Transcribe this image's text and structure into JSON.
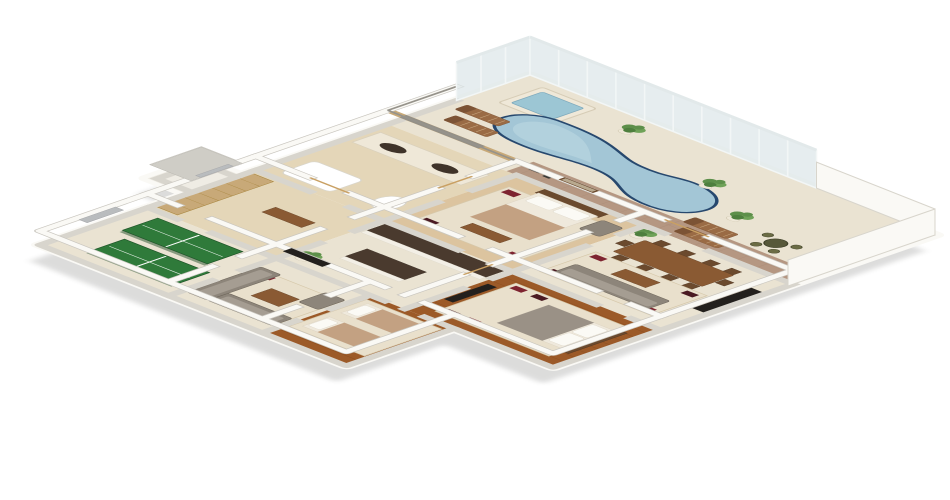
{
  "meta": {
    "type": "3d-isometric-floorplan-render",
    "canvas_width": 950,
    "canvas_height": 500,
    "background": "#ffffff"
  },
  "scene": {
    "title": "3D isometric floor plan render of a residence with a glass-walled pool terrace",
    "areas": [
      {
        "id": "pool-terrace",
        "label": "pool terrace"
      },
      {
        "id": "swimming-pool",
        "label": "kidney-shaped swimming pool"
      },
      {
        "id": "hot-tub",
        "label": "raised square hot tub"
      },
      {
        "id": "patio",
        "label": "brick paved patio"
      },
      {
        "id": "bathroom",
        "label": "bathroom with stone wall and double vanity"
      },
      {
        "id": "master-bedroom",
        "label": "master bedroom"
      },
      {
        "id": "dining-family-room",
        "label": "dining and family room"
      },
      {
        "id": "walk-in-closet",
        "label": "walk-in closet"
      },
      {
        "id": "kitchen",
        "label": "kitchen with granite counters"
      },
      {
        "id": "bedroom-2",
        "label": "bedroom with wood floor"
      },
      {
        "id": "games-room",
        "label": "games room with ping pong tables"
      },
      {
        "id": "tv-lounge",
        "label": "tv lounge with sectional sofa"
      },
      {
        "id": "bedroom-3",
        "label": "twin bedroom"
      },
      {
        "id": "porch",
        "label": "entry porch"
      }
    ],
    "furniture_counts": {
      "ping_pong_tables": 2,
      "sun_loungers": 4,
      "bistro_set_chairs": 4,
      "potted_plants": 6,
      "beds": 4,
      "sofa_groups": 3,
      "dining_chairs": 10
    }
  },
  "palette": {
    "background": "#ffffff",
    "wall_top": "#faf9f5",
    "wall_side": "#d8d5cd",
    "wall_edge": "#c9c6bf",
    "marble_floor": "#eae3d2",
    "tile_floor": "#dcc49f",
    "bath_tile": "#e4d6b8",
    "wood_floor": "#9c5a28",
    "plank_line": "#7c4319",
    "brick_patio": "#b59782",
    "pool_water": "#a3c6d6",
    "pool_edge": "#27486e",
    "hot_tub_water": "#9cc6d4",
    "glass": "#dce6e9",
    "glass_frame": "#f2f6f6",
    "granite": "#4a3a2e",
    "cabinet_white": "#f3efe6",
    "sofa_gray": "#8d857a",
    "sofa_light": "#a59d92",
    "rug_cream": "#e9e0cc",
    "rug_red": "#7e2430",
    "rug_dark": "#4a1a22",
    "bed_tan": "#c3a182",
    "bed_white": "#efe9dc",
    "table_wood": "#8a5a33",
    "wood_dark": "#6b4a2e",
    "pingpong_green": "#2f7a3a",
    "pingpong_edge": "#1f5428",
    "plant_green": "#5d8f4a",
    "plant_light": "#6fa258",
    "plant_dark": "#4e7f3e",
    "lounger_brown": "#9a6b45",
    "tv_dark": "#23201d",
    "stone_wall": "#c8a978",
    "stone_frame": "#c9a063",
    "door_gray": "#b9bcbe",
    "mirror_gray": "#8d8d89"
  }
}
